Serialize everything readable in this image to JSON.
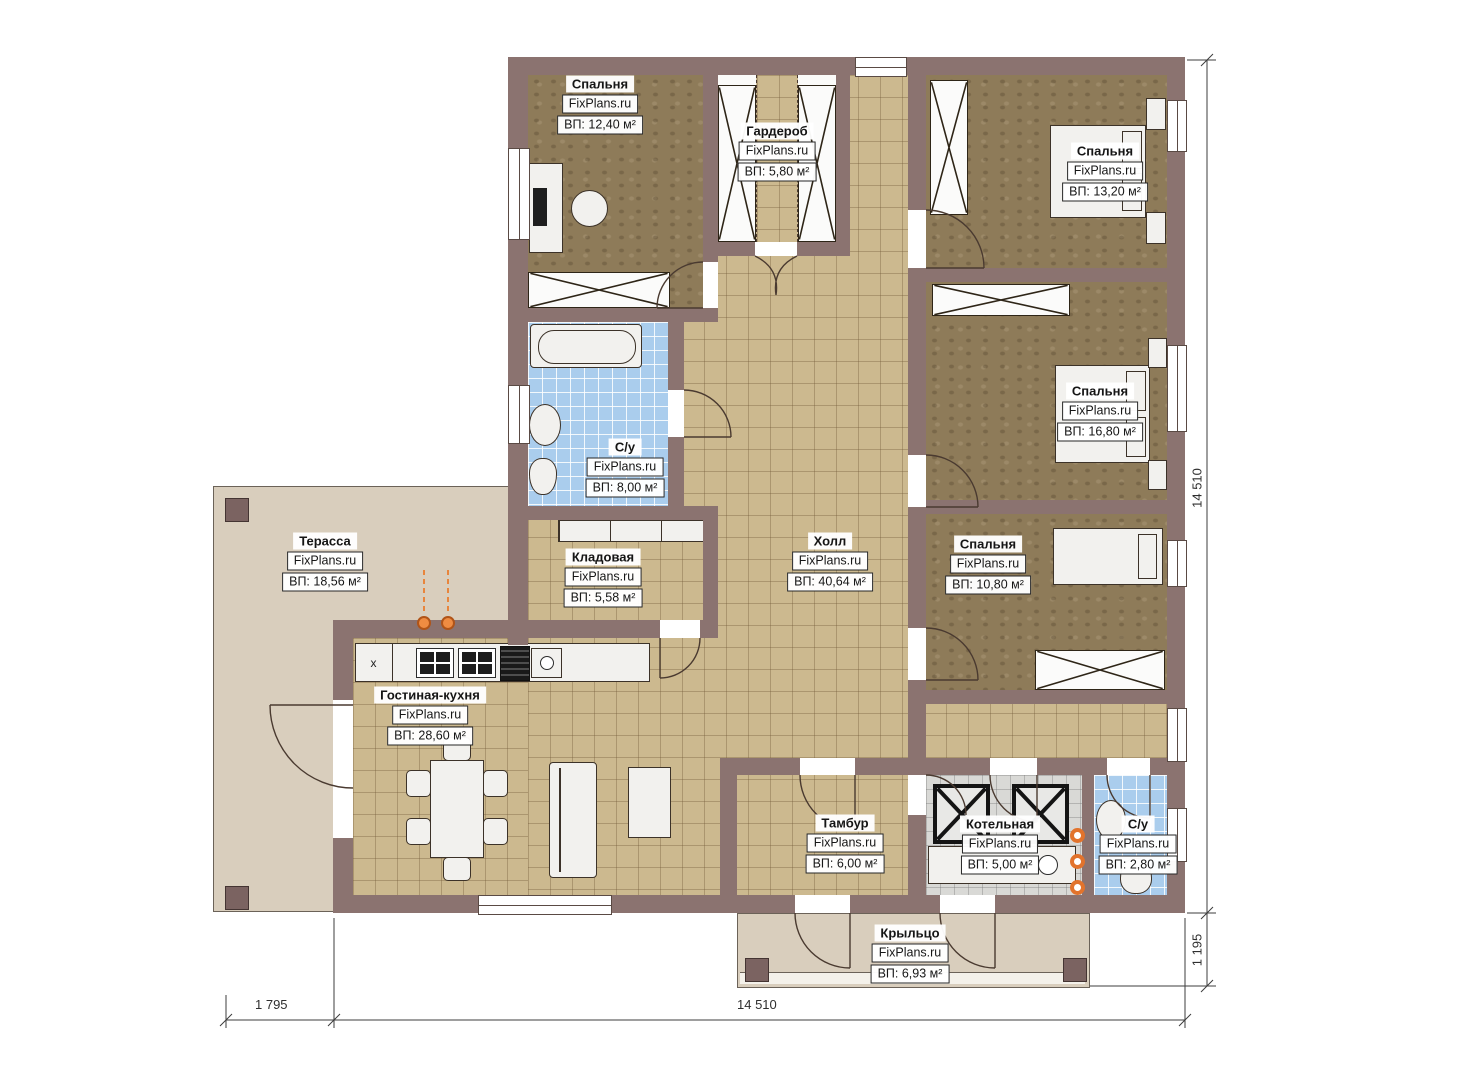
{
  "watermark": "FixPlans.ru",
  "rooms": [
    {
      "name": "Спальня",
      "area": "ВП: 12,40 м²"
    },
    {
      "name": "Гардероб",
      "area": "ВП: 5,80 м²"
    },
    {
      "name": "Спальня",
      "area": "ВП: 13,20 м²"
    },
    {
      "name": "С/у",
      "area": "ВП: 8,00 м²"
    },
    {
      "name": "Спальня",
      "area": "ВП: 16,80 м²"
    },
    {
      "name": "Терасса",
      "area": "ВП: 18,56 м²"
    },
    {
      "name": "Кладовая",
      "area": "ВП: 5,58 м²"
    },
    {
      "name": "Холл",
      "area": "ВП: 40,64 м²"
    },
    {
      "name": "Спальня",
      "area": "ВП: 10,80 м²"
    },
    {
      "name": "Гостиная-кухня",
      "area": "ВП: 28,60 м²"
    },
    {
      "name": "Тамбур",
      "area": "ВП: 6,00 м²"
    },
    {
      "name": "Котельная",
      "area": "ВП: 5,00 м²"
    },
    {
      "name": "С/у",
      "area": "ВП: 2,80 м²"
    },
    {
      "name": "Крыльцо",
      "area": "ВП: 6,93 м²"
    }
  ],
  "dimensions": {
    "height_total": "14 510",
    "porch_offset": "1 195",
    "terrace_offset": "1 795",
    "width_total": "14 510"
  },
  "marks": {
    "kitchen_x": "x"
  },
  "colors": {
    "wall": "#8b7370",
    "floor_tan": "#ccb98f",
    "floor_blue": "#aacded",
    "floor_brown": "#8e7b59",
    "deck": "#d9cebd",
    "accent_orange": "#e8762a"
  }
}
